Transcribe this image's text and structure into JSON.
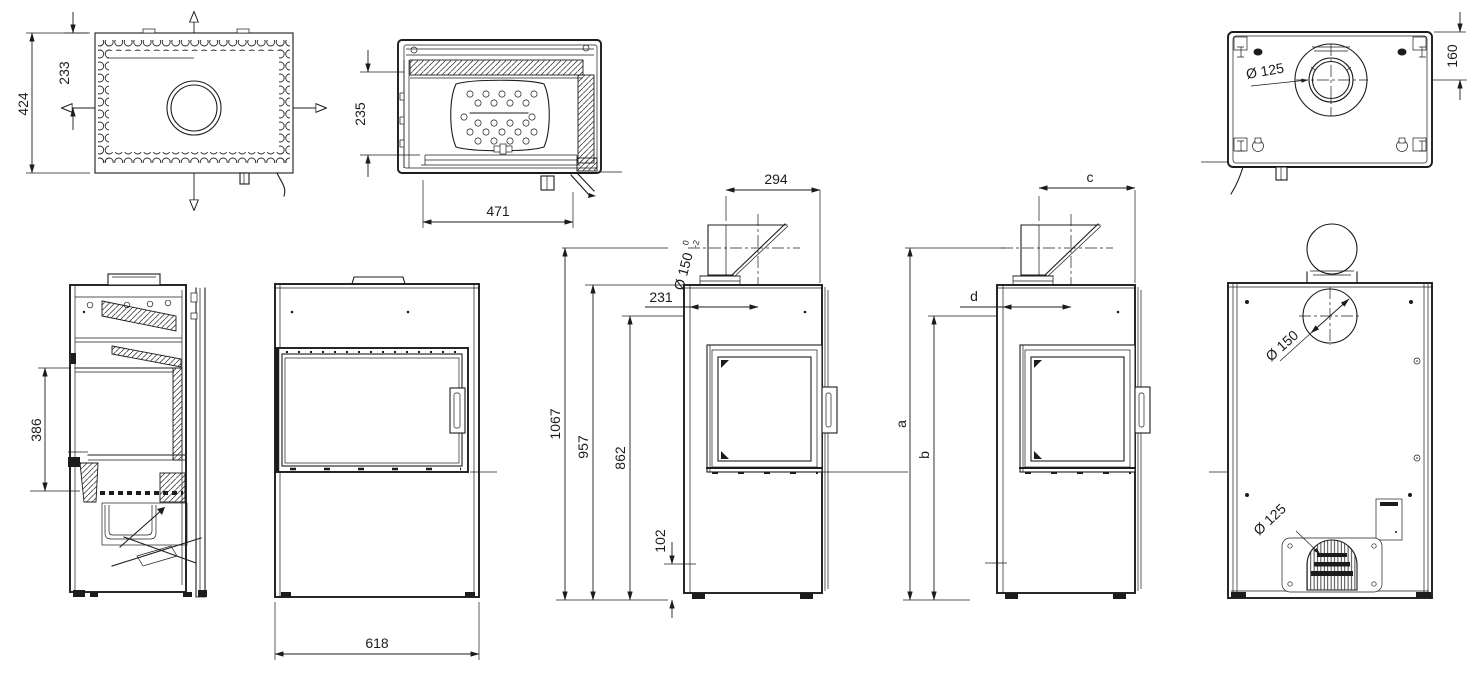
{
  "colors": {
    "background": "#ffffff",
    "line": "#1c1c1c"
  },
  "views": {
    "top_view": {
      "dim_depth_overall": "424",
      "dim_flue_center_offset": "233"
    },
    "firebox_top_section": {
      "dim_depth": "235",
      "dim_width": "471"
    },
    "bottom_view": {
      "dim_inlet_diameter": "Ø 125",
      "dim_flue_center_from_rear": "160"
    },
    "side_section": {
      "dim_firebox_opening_height": "386"
    },
    "front_view": {
      "dim_width_overall": "618"
    },
    "side_view_dimensioned": {
      "dim_flue_outlet_depth": "294",
      "dim_flue_diameter": "Ø 150",
      "dim_flue_diameter_tol_upper": "0",
      "dim_flue_diameter_tol_lower": "-2",
      "dim_flue_center_from_front": "231",
      "dim_height_to_flue_center": "1067",
      "dim_height_overall": "957",
      "dim_height_to_rear_outlet": "862",
      "dim_height_air_inlet": "102"
    },
    "side_view_lettered": {
      "dim_a": "a",
      "dim_b": "b",
      "dim_c": "c",
      "dim_d": "d"
    },
    "rear_view": {
      "dim_flue_diameter": "Ø 150",
      "dim_air_inlet_diameter": "Ø 125"
    }
  }
}
